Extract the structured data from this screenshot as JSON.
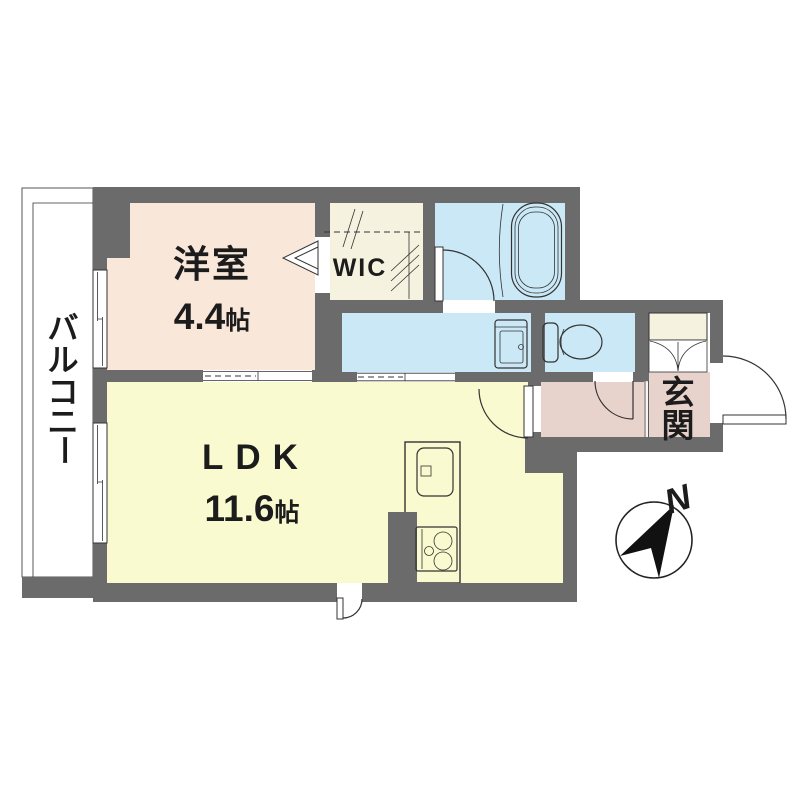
{
  "colors": {
    "wall": "#6b6b6b",
    "bedroom_floor": "#f9e7da",
    "ldk_floor": "#fafad0",
    "wet_floor": "#cbe8f6",
    "storage_floor": "#f6f2e0",
    "entrance_floor": "#e8d3cc",
    "line": "#333333",
    "text": "#1c1c1c"
  },
  "rooms": {
    "bedroom": {
      "name": "洋室",
      "size": "4.4帖",
      "size_num": "4.4",
      "size_unit": "帖"
    },
    "ldk": {
      "name": "LDK",
      "size": "11.6帖",
      "size_num": "11.6",
      "size_unit": "帖"
    },
    "wic": {
      "name": "WIC"
    },
    "entrance": {
      "name": "玄関",
      "chars": [
        "玄",
        "関"
      ]
    },
    "balcony": {
      "name": "バルコニー",
      "chars": [
        "バ",
        "ル",
        "コ",
        "ニ",
        "ー"
      ]
    }
  },
  "compass": {
    "north_label": "N"
  }
}
